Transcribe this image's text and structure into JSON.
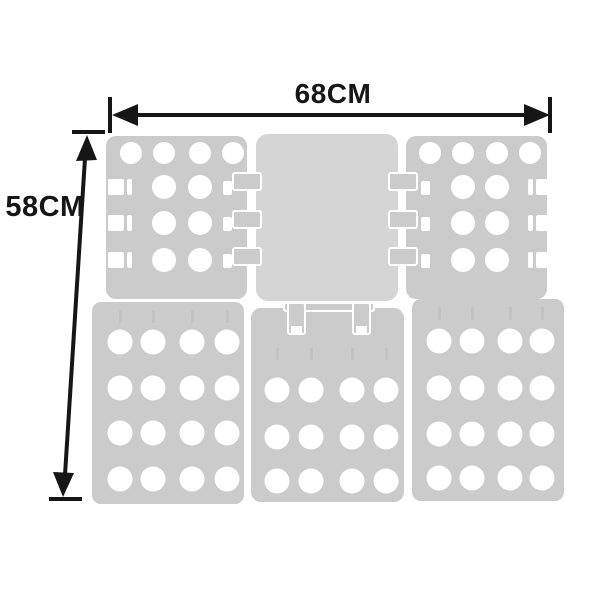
{
  "annotations": {
    "width_label": "68CM",
    "height_label": "58CM"
  },
  "colors": {
    "background": "#ffffff",
    "panel": "#cbcbcb",
    "panel_center": "#d5d5d5",
    "hole": "#ffffff",
    "dimension": "#161616",
    "crease_mark": "#b8b8b8"
  },
  "board": {
    "description": "five-section clothes folding board, front view",
    "panels": [
      {
        "id": "panel-top-left",
        "x": 106,
        "y": 136,
        "w": 141,
        "h": 163,
        "rx": 10,
        "fill": "panel",
        "holes": [
          [
            131,
            153,
            11
          ],
          [
            164,
            153,
            11
          ],
          [
            200,
            153,
            11
          ],
          [
            233,
            153,
            11
          ],
          [
            164,
            187,
            12
          ],
          [
            200,
            187,
            12
          ],
          [
            164,
            223,
            12
          ],
          [
            200,
            223,
            12
          ],
          [
            164,
            260,
            12
          ],
          [
            200,
            260,
            12
          ]
        ],
        "slots": [
          [
            108,
            179,
            16,
            16
          ],
          [
            127,
            179,
            5,
            16
          ],
          [
            108,
            215,
            16,
            16
          ],
          [
            127,
            215,
            5,
            16
          ],
          [
            108,
            252,
            16,
            16
          ],
          [
            127,
            252,
            5,
            16
          ],
          [
            223,
            181,
            9,
            14
          ],
          [
            223,
            217,
            9,
            14
          ],
          [
            223,
            254,
            9,
            14
          ]
        ],
        "marks": []
      },
      {
        "id": "panel-top-center",
        "x": 256,
        "y": 134,
        "w": 142,
        "h": 167,
        "rx": 12,
        "fill": "panel_center",
        "holes": [],
        "slots": [],
        "marks": []
      },
      {
        "id": "panel-top-right",
        "x": 406,
        "y": 136,
        "w": 141,
        "h": 163,
        "rx": 10,
        "fill": "panel",
        "holes": [
          [
            430,
            153,
            11
          ],
          [
            463,
            153,
            11
          ],
          [
            497,
            153,
            11
          ],
          [
            530,
            153,
            11
          ],
          [
            463,
            187,
            12
          ],
          [
            497,
            187,
            12
          ],
          [
            463,
            223,
            12
          ],
          [
            497,
            223,
            12
          ],
          [
            463,
            260,
            12
          ],
          [
            497,
            260,
            12
          ]
        ],
        "slots": [
          [
            528,
            179,
            5,
            16
          ],
          [
            536,
            179,
            16,
            16
          ],
          [
            528,
            215,
            5,
            16
          ],
          [
            536,
            215,
            16,
            16
          ],
          [
            528,
            252,
            5,
            16
          ],
          [
            536,
            252,
            16,
            16
          ],
          [
            421,
            181,
            9,
            14
          ],
          [
            421,
            217,
            9,
            14
          ],
          [
            421,
            254,
            9,
            14
          ]
        ],
        "marks": []
      },
      {
        "id": "panel-bottom-left",
        "x": 92,
        "y": 302,
        "w": 152,
        "h": 202,
        "rx": 9,
        "fill": "panel",
        "holes": [
          [
            120,
            342,
            12.5
          ],
          [
            153,
            342,
            12.5
          ],
          [
            192,
            342,
            12.5
          ],
          [
            227,
            342,
            12.5
          ],
          [
            120,
            388,
            12.5
          ],
          [
            153,
            388,
            12.5
          ],
          [
            192,
            388,
            12.5
          ],
          [
            227,
            388,
            12.5
          ],
          [
            120,
            433,
            12.5
          ],
          [
            153,
            433,
            12.5
          ],
          [
            192,
            433,
            12.5
          ],
          [
            227,
            433,
            12.5
          ],
          [
            120,
            479,
            12.5
          ],
          [
            153,
            479,
            12.5
          ],
          [
            192,
            479,
            12.5
          ],
          [
            227,
            479,
            12.5
          ]
        ],
        "slots": [],
        "marks": [
          [
            119,
            310,
            3,
            13
          ],
          [
            152,
            310,
            3,
            13
          ],
          [
            191,
            310,
            3,
            13
          ],
          [
            226,
            310,
            3,
            13
          ]
        ]
      },
      {
        "id": "panel-bottom-center",
        "x": 251,
        "y": 308,
        "w": 153,
        "h": 194,
        "rx": 10,
        "fill": "panel",
        "holes": [
          [
            277,
            390,
            12.5
          ],
          [
            311,
            390,
            12.5
          ],
          [
            352,
            390,
            12.5
          ],
          [
            386,
            390,
            12.5
          ],
          [
            277,
            437,
            12.5
          ],
          [
            311,
            437,
            12.5
          ],
          [
            352,
            437,
            12.5
          ],
          [
            386,
            437,
            12.5
          ],
          [
            277,
            481,
            12.5
          ],
          [
            311,
            481,
            12.5
          ],
          [
            352,
            481,
            12.5
          ],
          [
            386,
            481,
            12.5
          ]
        ],
        "slots": [],
        "marks": [
          [
            276,
            348,
            3,
            12
          ],
          [
            310,
            348,
            3,
            12
          ],
          [
            351,
            348,
            3,
            12
          ],
          [
            385,
            348,
            3,
            12
          ]
        ]
      },
      {
        "id": "panel-bottom-right",
        "x": 412,
        "y": 299,
        "w": 152,
        "h": 202,
        "rx": 9,
        "fill": "panel",
        "holes": [
          [
            439,
            341,
            12.5
          ],
          [
            472,
            341,
            12.5
          ],
          [
            510,
            341,
            12.5
          ],
          [
            542,
            341,
            12.5
          ],
          [
            439,
            388,
            12.5
          ],
          [
            472,
            388,
            12.5
          ],
          [
            510,
            388,
            12.5
          ],
          [
            542,
            388,
            12.5
          ],
          [
            439,
            434,
            12.5
          ],
          [
            472,
            434,
            12.5
          ],
          [
            510,
            434,
            12.5
          ],
          [
            542,
            434,
            12.5
          ],
          [
            439,
            478,
            12.5
          ],
          [
            472,
            478,
            12.5
          ],
          [
            510,
            478,
            12.5
          ],
          [
            542,
            478,
            12.5
          ]
        ],
        "slots": [],
        "marks": [
          [
            438,
            307,
            3,
            13
          ],
          [
            471,
            307,
            3,
            13
          ],
          [
            509,
            307,
            3,
            13
          ],
          [
            541,
            307,
            3,
            13
          ]
        ]
      }
    ],
    "tabs": [
      [
        233,
        173,
        28,
        17
      ],
      [
        233,
        211,
        28,
        17
      ],
      [
        233,
        248,
        28,
        17
      ],
      [
        389,
        173,
        28,
        17
      ],
      [
        389,
        211,
        28,
        17
      ],
      [
        389,
        248,
        28,
        17
      ],
      [
        284,
        303,
        90,
        8
      ],
      [
        288,
        303,
        17,
        31
      ],
      [
        353,
        303,
        17,
        31
      ]
    ],
    "tab_slots": [
      [
        291,
        326,
        11,
        9
      ],
      [
        356,
        326,
        11,
        9
      ]
    ]
  }
}
